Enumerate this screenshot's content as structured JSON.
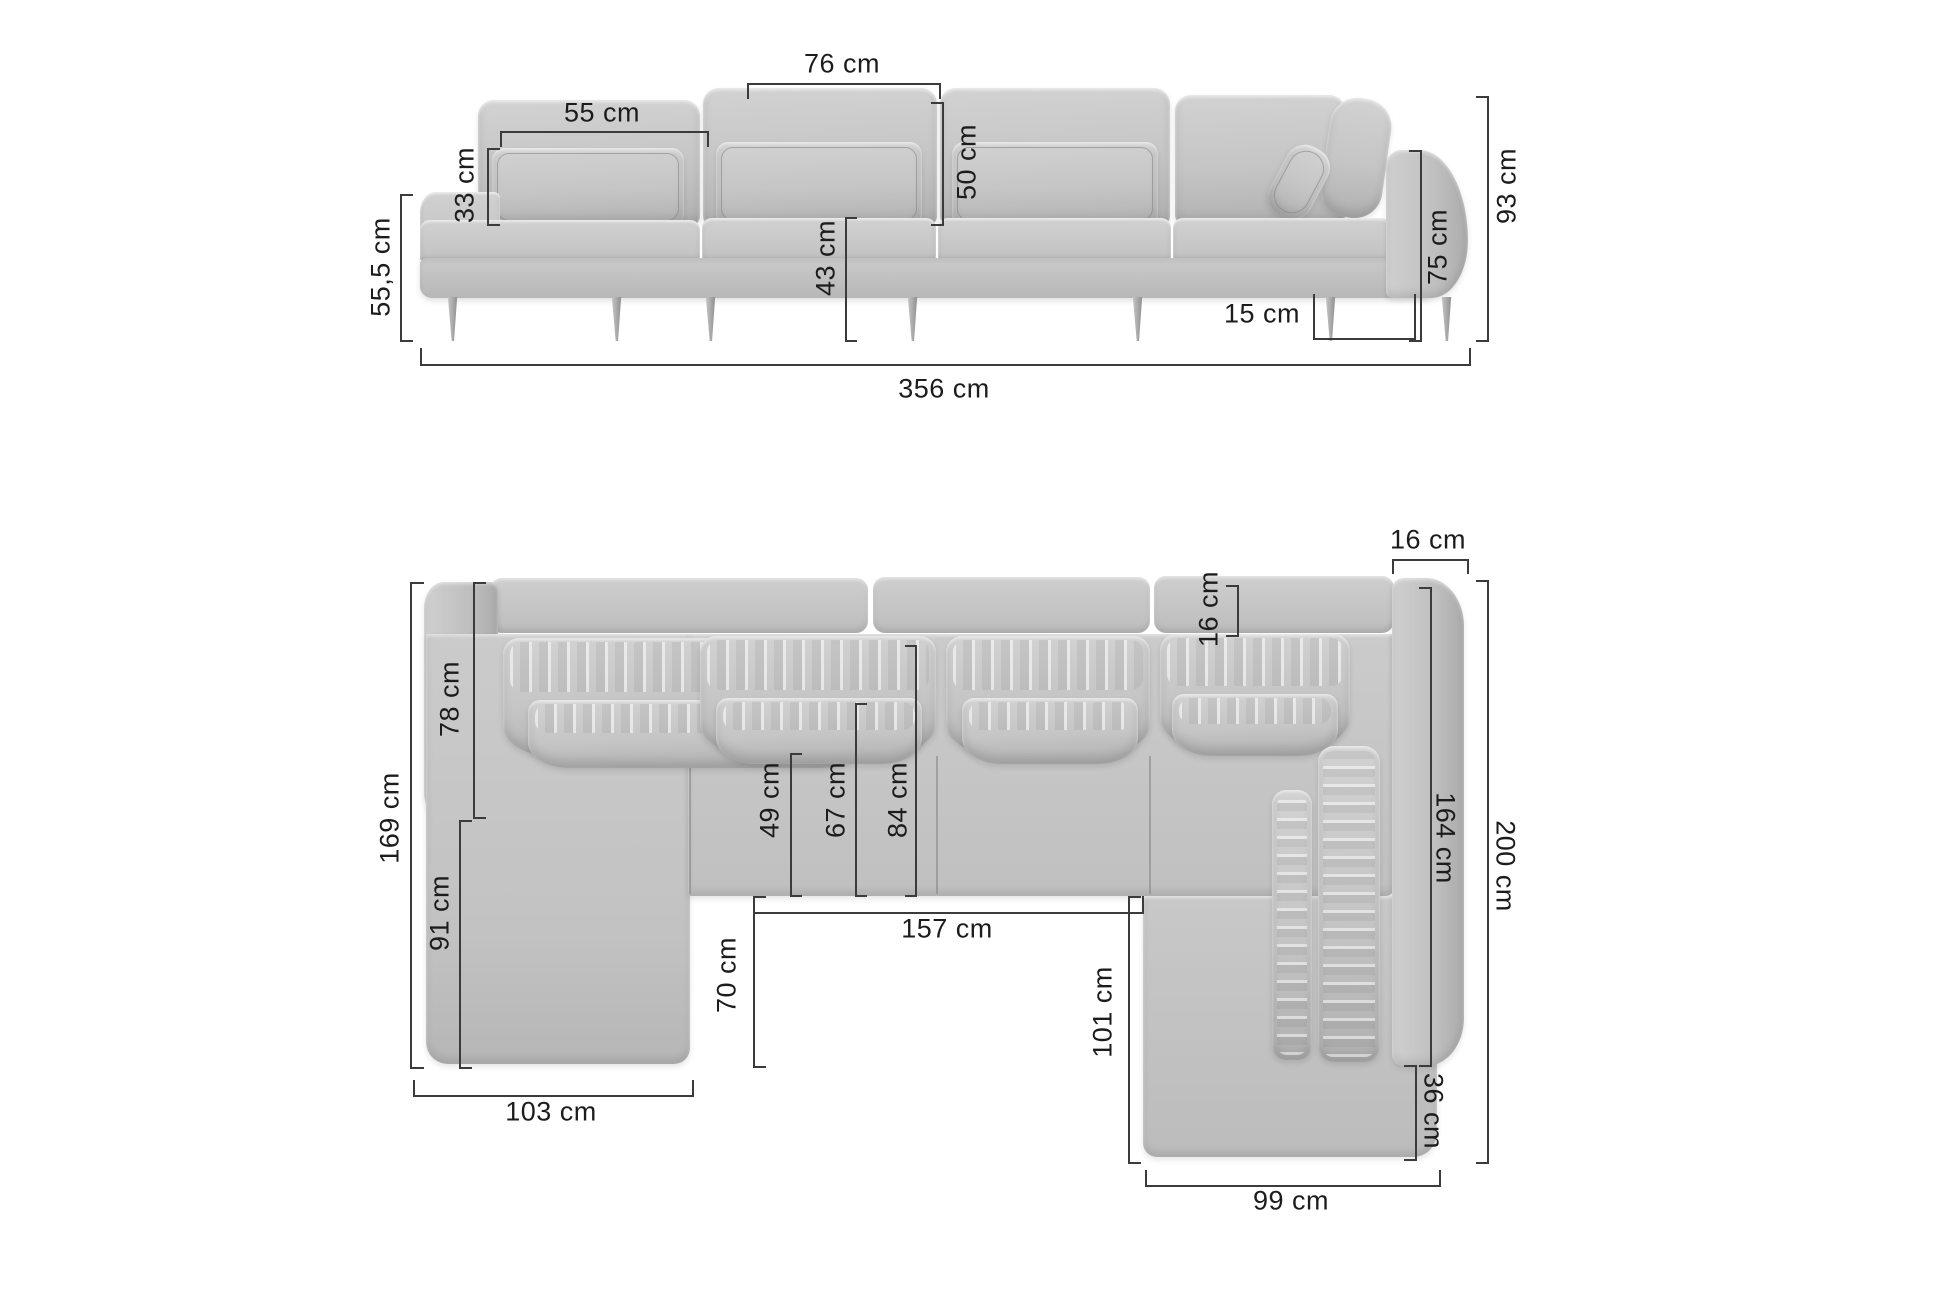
{
  "palette": {
    "background": "#ffffff",
    "fabric": "#c6c6c6",
    "fabric_light": "#d6d6d6",
    "fabric_dark": "#a8a8a8",
    "dim_line": "#3b3b3b",
    "dim_text": "#1c1c1c"
  },
  "front_view": {
    "dims": {
      "back_module_width": "76 cm",
      "pillow_width": "55 cm",
      "pillow_height": "33 cm",
      "backrest_height": "50 cm",
      "open_end_height": "55,5 cm",
      "seat_height": "43 cm",
      "armrest_height": "75 cm",
      "total_height": "93 cm",
      "leg_inset": "15 cm",
      "total_width": "356 cm"
    }
  },
  "top_view": {
    "dims": {
      "armrest_width": "16 cm",
      "backrest_depth": "16 cm",
      "side_backrest_length": "78 cm",
      "left_side_length": "169 cm",
      "chaise_side_length": "91 cm",
      "pillow_front_depth": "49 cm",
      "mid_pillow_depth": "67 cm",
      "seat_depth": "84 cm",
      "inner_width": "157 cm",
      "chaise_extension_depth": "70 cm",
      "ottoman_side_length": "101 cm",
      "right_inner_length": "164 cm",
      "total_depth": "200 cm",
      "chaise_width": "103 cm",
      "ottoman_back_depth": "36 cm",
      "ottoman_width": "99 cm"
    }
  }
}
